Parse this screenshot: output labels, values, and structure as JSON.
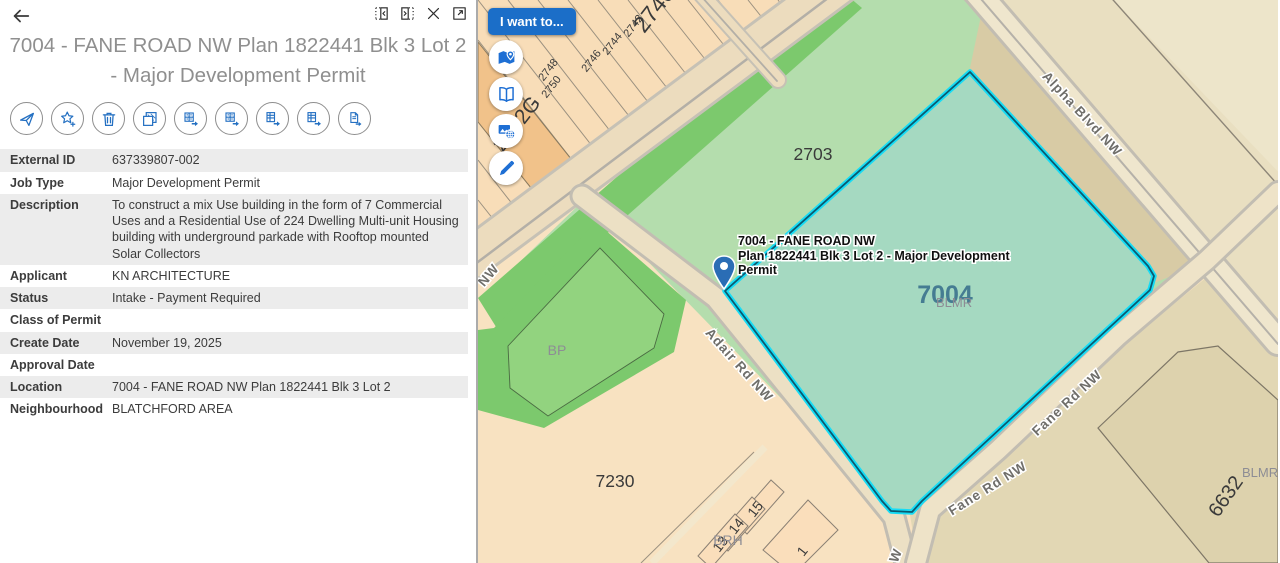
{
  "panel": {
    "back_icon": "back-arrow",
    "window_icons": [
      "dock-panel-left",
      "dock-panel-right",
      "close",
      "open-new-window"
    ],
    "title": "7004 - FANE ROAD NW Plan 1822441 Blk 3 Lot 2 - Major Development Permit",
    "action_icons": [
      "zoom-to-feature",
      "add-to-favorites",
      "delete",
      "copy",
      "export-table-1",
      "export-table-2",
      "export-table-3",
      "export-table-4",
      "export-report"
    ],
    "fields": [
      {
        "label": "External ID",
        "value": "637339807-002"
      },
      {
        "label": "Job Type",
        "value": "Major Development Permit"
      },
      {
        "label": "Description",
        "value": "To construct a mix Use building in the form of 7 Commercial Uses and a Residential Use of 224 Dwelling Multi-unit Housing building with underground parkade with Rooftop mounted Solar Collectors"
      },
      {
        "label": "Applicant",
        "value": "KN ARCHITECTURE"
      },
      {
        "label": "Status",
        "value": "Intake - Payment Required"
      },
      {
        "label": "Class of Permit",
        "value": ""
      },
      {
        "label": "Create Date",
        "value": "November 19, 2025"
      },
      {
        "label": "Approval Date",
        "value": ""
      },
      {
        "label": "Location",
        "value": "7004 - FANE ROAD NW Plan 1822441 Blk 3 Lot 2"
      },
      {
        "label": "Neighbourhood",
        "value": "BLATCHFORD AREA"
      }
    ]
  },
  "map": {
    "i_want_to_label": "I want to...",
    "tool_icons": [
      "show-on-map",
      "bookmarks",
      "basemap-gallery",
      "draw"
    ],
    "callout": {
      "line1": "7004 - FANE ROAD NW",
      "line2": "Plan 1822441 Blk 3 Lot 2 - Major Development",
      "line3": "Permit"
    },
    "labels": {
      "lot_2740": "2740",
      "lot_2742": "2742",
      "lot_2744": "2744",
      "lot_2746": "2746",
      "lot_2748": "2748",
      "lot_2750": "2750",
      "lot_2752g": "2752G",
      "lot_partial": "275",
      "parcel_2703": "2703",
      "parcel_7004": "7004",
      "parcel_blmr": "BLMR",
      "parcel_blmr2": "BLMR",
      "parcel_bp": "BP",
      "parcel_7230": "7230",
      "parcel_6632": "6632",
      "parcel_brh": "BRH",
      "lot_15": "15",
      "lot_14": "14",
      "lot_13": "13",
      "lot_1": "1",
      "street_alpha": "Alpha Blvd NW",
      "street_adair": "Adair Rd NW",
      "street_fane1": "Fane Rd NW",
      "street_fane2": "Fane Rd NW",
      "street_partial_nw": "NW",
      "street_partial_w": "W"
    },
    "colors": {
      "selection_outline": "#17dcf5",
      "selection_core": "#0a5a70",
      "selected_parcel_fill": "#a5d9c1",
      "accent_blue": "#1b6ec8"
    }
  }
}
